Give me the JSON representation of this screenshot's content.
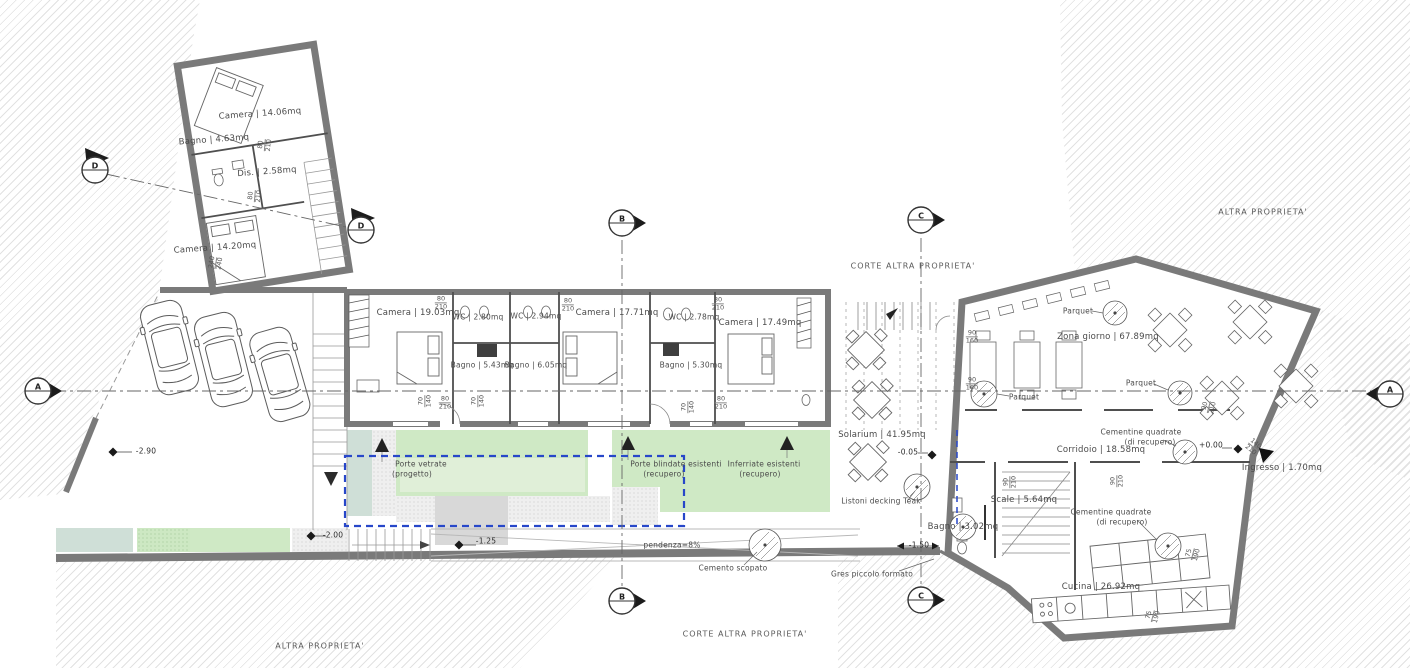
{
  "plan": {
    "property_labels": {
      "top_right": "ALTRA PROPRIETA'",
      "bottom_left": "ALTRA PROPRIETA'",
      "corte_top": "CORTE ALTRA PROPRIETA'",
      "corte_bottom": "CORTE ALTRA PROPRIETA'"
    },
    "buildings": {
      "upper_left": {
        "camera_top": "Camera | 14.06mq",
        "bagno": "Bagno | 4.63mq",
        "dis": "Dis. | 2.58mq",
        "camera_bottom": "Camera | 14.20mq"
      },
      "middle": {
        "camera_1": "Camera | 19.03mq",
        "wc_1": "WC | 2.80mq",
        "bagno_1": "Bagno | 5.43mq",
        "wc_2": "WC | 2.94mq",
        "bagno_2": "Bagno | 6.05mq",
        "camera_2": "Camera | 17.71mq",
        "wc_3": "WC | 2.78mq",
        "bagno_3": "Bagno | 5.30mq",
        "camera_3": "Camera | 17.49mq"
      },
      "right": {
        "zona_giorno": "Zona giorno | 67.89mq",
        "parquet": "Parquet",
        "corridoio": "Corridoio | 18.58mq",
        "cementine_line1": "Cementine quadrate",
        "cementine_line2": "(di recupero)",
        "ingresso": "Ingresso | 1.70mq",
        "scale": "Scale | 5.64mq",
        "bagno": "Bagno | 3.02mq",
        "cucina": "Cucina | 26.92mq"
      }
    },
    "outdoor": {
      "solarium": "Solarium | 41.95mq",
      "decking": "Listoni decking Teak",
      "pendenza": "pendenza=8%",
      "cemento": "Cemento scopato",
      "gres": "Gres piccolo formato"
    },
    "legend": {
      "porte_vetrate_1": "Porte vetrate",
      "porte_vetrate_2": "(progetto)",
      "porte_blindate_1": "Porte blindate esistenti",
      "porte_blindate_2": "(recupero)",
      "inferriate_1": "Inferriate esistenti",
      "inferriate_2": "(recupero)"
    },
    "levels": {
      "minus290": "-2.90",
      "minus200": "-2.00",
      "minus125": "-1.25",
      "minus005": "-0.05",
      "minus150": "-1.50",
      "plus000": "+0.00"
    },
    "sections": {
      "a": "A",
      "b": "B",
      "c": "C",
      "d": "D"
    },
    "dims": {
      "d80210": {
        "w": "80",
        "h": "210"
      },
      "d70140": {
        "w": "70",
        "h": "140"
      },
      "d90160": {
        "w": "90",
        "h": "160"
      },
      "d90210": {
        "w": "90",
        "h": "210"
      },
      "d240240": {
        "w": "240",
        "h": "240"
      },
      "d140210": {
        "w": "140",
        "h": "210"
      },
      "d75190": {
        "w": "75",
        "h": "190"
      }
    },
    "colors": {
      "wall": "#7a7a7a",
      "partition": "#4f4f4f",
      "green": "#cfe9c5",
      "green_pale": "#e0efd8",
      "teal": "#cfdfd7",
      "gravel": "#efefef",
      "accent_blue": "#2747c9",
      "hatch": "#e2e2e2"
    }
  }
}
